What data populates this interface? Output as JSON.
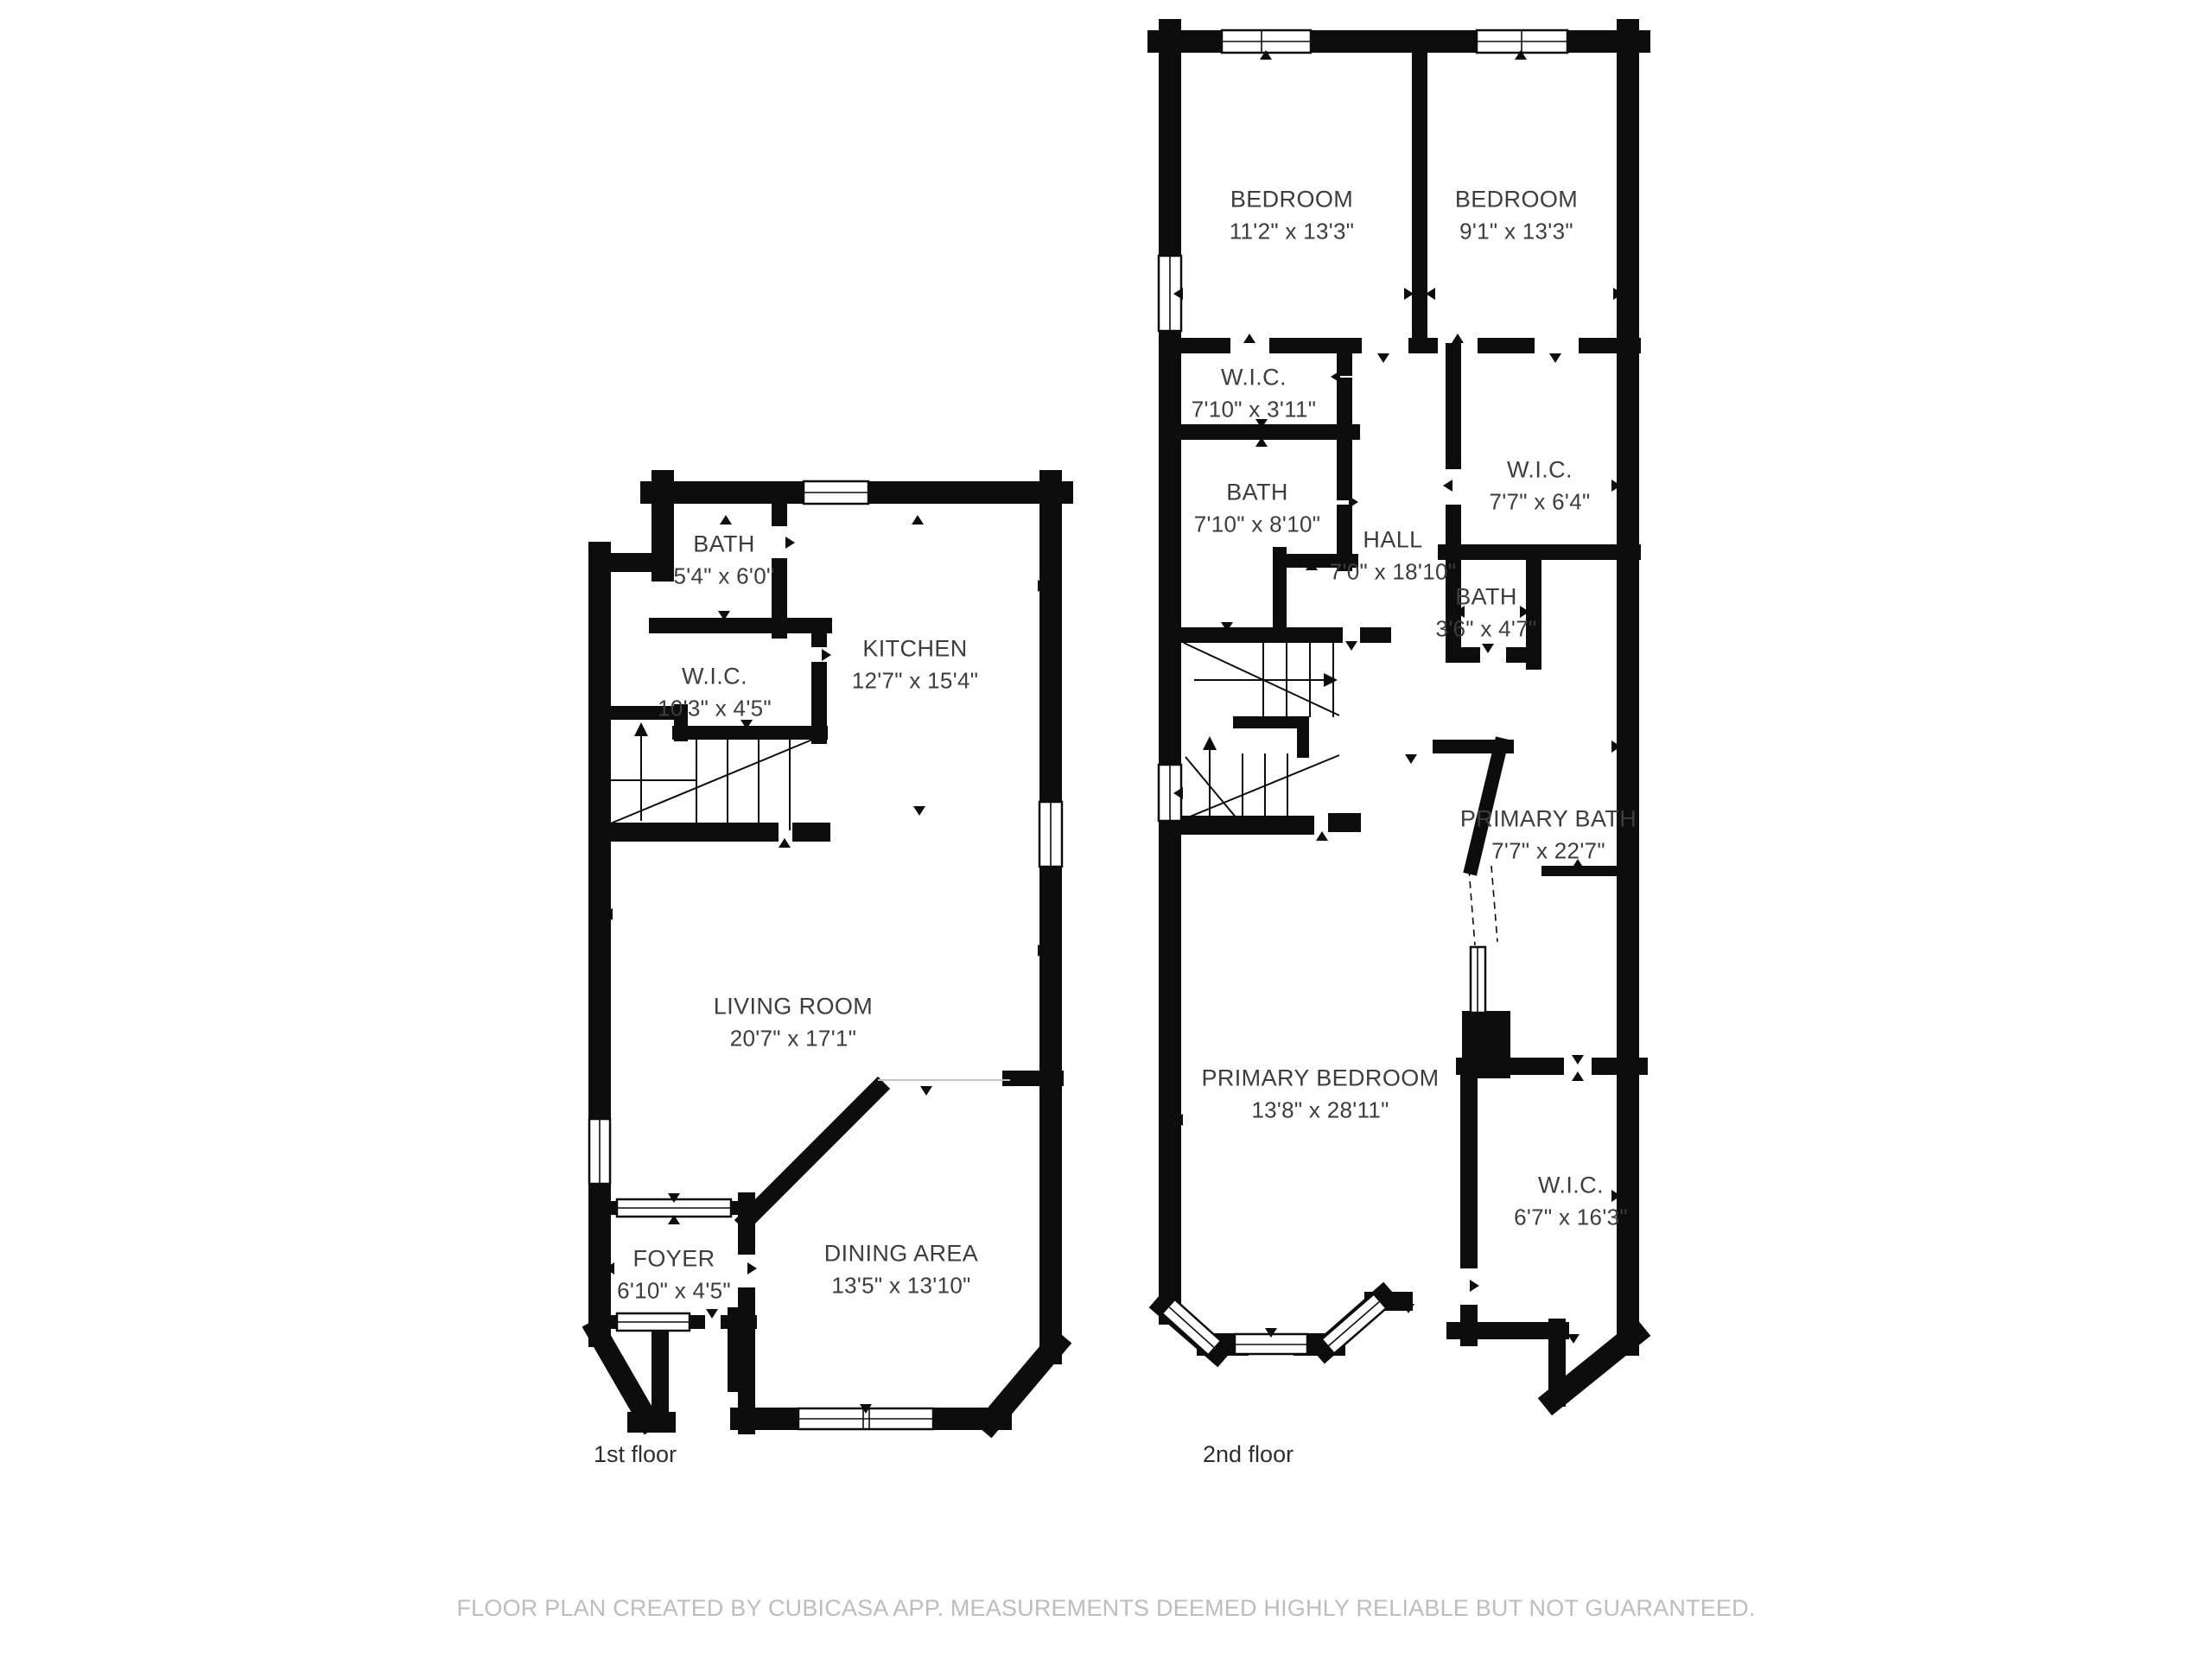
{
  "colors": {
    "background": "#ffffff",
    "wall": "#0d0d0d",
    "room_label": "#3d3d3d",
    "floor_label": "#2e2e2e",
    "disclaimer": "#bdbdbd"
  },
  "floors": [
    {
      "label": "1st floor",
      "rooms": [
        {
          "name": "BATH",
          "dims": "5'4\" x 6'0\""
        },
        {
          "name": "W.I.C.",
          "dims": "10'3\" x 4'5\""
        },
        {
          "name": "KITCHEN",
          "dims": "12'7\" x 15'4\""
        },
        {
          "name": "LIVING ROOM",
          "dims": "20'7\" x 17'1\""
        },
        {
          "name": "FOYER",
          "dims": "6'10\" x 4'5\""
        },
        {
          "name": "DINING AREA",
          "dims": "13'5\" x 13'10\""
        }
      ]
    },
    {
      "label": "2nd floor",
      "rooms": [
        {
          "name": "BEDROOM",
          "dims": "11'2\" x 13'3\""
        },
        {
          "name": "BEDROOM",
          "dims": "9'1\" x 13'3\""
        },
        {
          "name": "W.I.C.",
          "dims": "7'10\" x 3'11\""
        },
        {
          "name": "BATH",
          "dims": "7'10\" x 8'10\""
        },
        {
          "name": "HALL",
          "dims": "7'0\" x 18'10\""
        },
        {
          "name": "W.I.C.",
          "dims": "7'7\" x 6'4\""
        },
        {
          "name": "BATH",
          "dims": "3'6\" x 4'7\""
        },
        {
          "name": "PRIMARY BATH",
          "dims": "7'7\" x 22'7\""
        },
        {
          "name": "PRIMARY BEDROOM",
          "dims": "13'8\" x 28'11\""
        },
        {
          "name": "W.I.C.",
          "dims": "6'7\" x 16'3\""
        }
      ]
    }
  ],
  "footer": {
    "disclaimer": "FLOOR PLAN CREATED BY CUBICASA APP. MEASUREMENTS DEEMED HIGHLY RELIABLE BUT NOT GUARANTEED."
  }
}
